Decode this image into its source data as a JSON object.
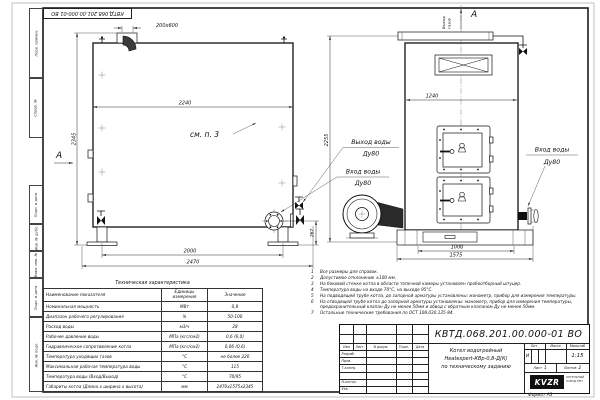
{
  "frame": {
    "stamp": "КВТД.068.201.00.000-01 ВО",
    "labels": [
      "Перв. примен.",
      "Справ. №",
      "Подп. и дата",
      "Инв. № дубл.",
      "Взам. инв. №",
      "Подп. и дата",
      "Инв. № подл."
    ]
  },
  "drawing": {
    "dim_stub": "200х600",
    "dim_side_width": "2240",
    "dim_side_height": "2345",
    "dim_base_span": "2000",
    "dim_length": "2470",
    "dim_pipe_h": "267",
    "dim_front_width": "1240",
    "dim_front_height": "2255",
    "dim_front_base_inner": "1000",
    "dim_front_base": "1575",
    "see_note": "см. п. 3",
    "view_letter_side": "А",
    "view_letter_front": "А",
    "gas_out_1": "Выход",
    "gas_out_2": "газов",
    "water_out_1": "Выход воды",
    "water_out_2": "Ду80",
    "water_in_1": "Вход воды",
    "water_in_2": "Ду80",
    "water_in_r_1": "Вход воды",
    "water_in_r_2": "Ду80"
  },
  "tech_table": {
    "title": "Техническая характеристика",
    "headers": [
      "Наименование показателя",
      "Единицы измерения",
      "Значение"
    ],
    "rows": [
      [
        "Номинальная мощность",
        "МВт",
        "0,8"
      ],
      [
        "Диапазон рабочего регулирования",
        "%",
        "50-100"
      ],
      [
        "Расход воды",
        "м3/ч",
        "28"
      ],
      [
        "Рабочее давление воды",
        "МПа (кгс/см2)",
        "0,6 (6,0)"
      ],
      [
        "Гидравлическое сопротивление котла",
        "МПа (кгс/см2)",
        "0,06 (0,6)"
      ],
      [
        "Температура уходящих газов",
        "°С",
        "не более 220"
      ],
      [
        "Максимальная рабочая температура воды",
        "°С",
        "115"
      ],
      [
        "Температура воды (Вход/Выход)",
        "°С",
        "70/95"
      ],
      [
        "Габариты котла (Длина х ширина х высота)",
        "мм",
        "2470х1575х2345"
      ]
    ]
  },
  "notes": [
    {
      "n": "1",
      "t": "Все размеры для справок."
    },
    {
      "n": "2",
      "t": "Допустимое отклонение ±100 мм."
    },
    {
      "n": "3",
      "t": "На боковой стенке котла в области топочной камеры установлен пробоотборный штуцер."
    },
    {
      "n": "4",
      "t": "Температура воды на входе 70°С, на выходе 95°С."
    },
    {
      "n": "5",
      "t": "На подводящей трубе котла, до запорной арматуры установлены: манометр, прибор для измерения температуры."
    },
    {
      "n": "6",
      "t": "На отводящей трубе котла до запорной арматуры установлены: манометр, прибор для измерения температуры, предохранительный клапан Ду не менее 50мм и обвод с обратным клапаном Ду не менее 50мм."
    },
    {
      "n": "7",
      "t": "Остальные технические требования по ОСТ 108.030.135-84."
    }
  ],
  "title_block": {
    "doc_number": "КВТД.068.201.00.000-01 ВО",
    "product_line1": "Котел водогрейный",
    "product_line2": "Heatexpert-КВр-0,8-Д(К)",
    "product_line3": "по техническому заданию",
    "header_izm": "Изм",
    "header_list": "Лист",
    "header_doc": "N докум.",
    "header_podp": "Подп.",
    "header_data": "Дата",
    "row1": "Разраб.",
    "row2": "Пров.",
    "row3": "Т.контр.",
    "row4": "",
    "row5": "Н.контр.",
    "row6": "Утв.",
    "lit_label": "Лит.",
    "mass_label": "Масса",
    "scale_label": "Масштаб",
    "lit_value": "И",
    "scale_value": "1:15",
    "sheet_label": "Лист",
    "sheet_value": "1",
    "sheets_label": "Листов",
    "sheets_value": "2",
    "logo_text": "KVZR",
    "logo_sub1": "КОТЕЛЬНЫЙ",
    "logo_sub2": "ЗАВОД РЭП",
    "format_label": "Формат  А3"
  }
}
